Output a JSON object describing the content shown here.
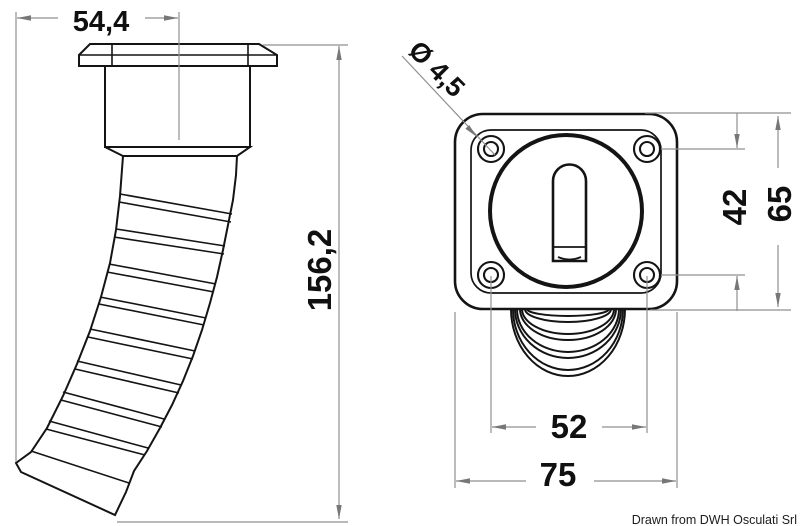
{
  "credit": "Drawn from DWH Osculati Srl",
  "dimensions": {
    "overall_width": "54,4",
    "overall_height": "156,2",
    "screw_hole_diameter": "Ø 4,5",
    "hole_spacing_vertical": "42",
    "flange_height": "65",
    "hole_spacing_horizontal": "52",
    "flange_width": "75"
  },
  "colors": {
    "outline": "#141414",
    "dimension_lines": "#8f8f8f",
    "dimension_text": "#101010",
    "background": "#ffffff"
  }
}
